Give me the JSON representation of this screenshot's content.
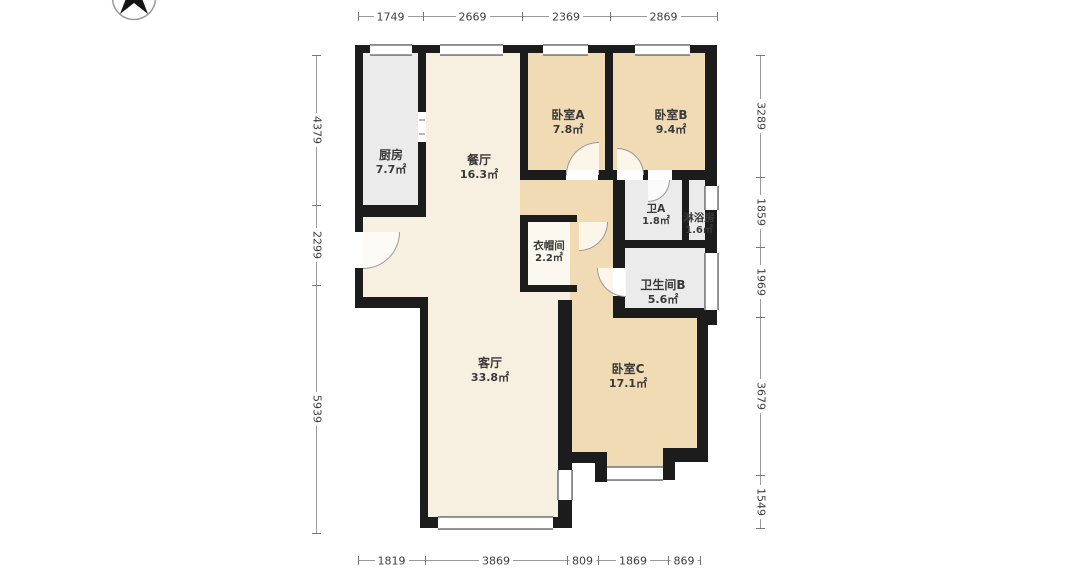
{
  "title": "户型图",
  "compass": {
    "icon": "north-compass"
  },
  "dimensions": {
    "top": [
      "1749",
      "2669",
      "2369",
      "2869"
    ],
    "bottom": [
      "1819",
      "3869",
      "809",
      "1869",
      "869"
    ],
    "left": [
      "4379",
      "2299",
      "5939"
    ],
    "right": [
      "3289",
      "1859",
      "1969",
      "3679",
      "1549"
    ]
  },
  "rooms": {
    "kitchen": {
      "name": "厨房",
      "area": "7.7㎡"
    },
    "dining": {
      "name": "餐厅",
      "area": "16.3㎡"
    },
    "bedroomA": {
      "name": "卧室A",
      "area": "7.8㎡"
    },
    "bedroomB": {
      "name": "卧室B",
      "area": "9.4㎡"
    },
    "toiletA": {
      "name": "卫A",
      "area": "1.8㎡"
    },
    "shower": {
      "name": "淋浴房",
      "area": "1.6㎡"
    },
    "bathroomB": {
      "name": "卫生间B",
      "area": "5.6㎡"
    },
    "cloakroom": {
      "name": "衣帽间",
      "area": "2.2㎡"
    },
    "living": {
      "name": "客厅",
      "area": "33.8㎡"
    },
    "bedroomC": {
      "name": "卧室C",
      "area": "17.1㎡"
    }
  },
  "colors": {
    "wall": "#1c1c1c",
    "floor_living_dining": "#f7efdf",
    "floor_bedroom_hall": "#f0dbb4",
    "floor_wet_room": "#ebebeb",
    "floor_cloakroom": "#fbf8f0",
    "dimension_text": "#3d3d3d"
  }
}
